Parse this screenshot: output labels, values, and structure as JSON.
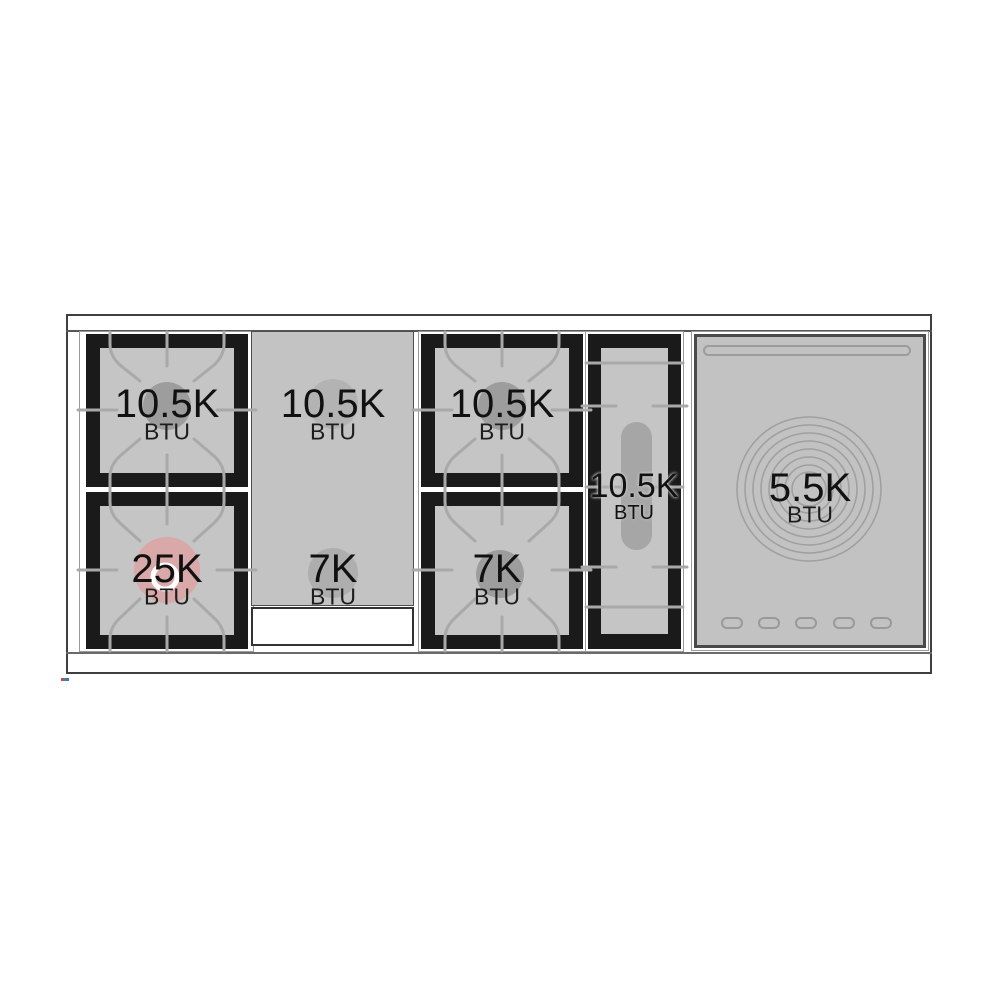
{
  "diagram": {
    "name": "range-cooktop-btu-diagram",
    "burners": [
      {
        "id": "left-top",
        "value": "10.5K",
        "unit": "BTU"
      },
      {
        "id": "left-bottom",
        "value": "25K",
        "unit": "BTU",
        "highlight": true
      },
      {
        "id": "griddle-top",
        "value": "10.5K",
        "unit": "BTU"
      },
      {
        "id": "griddle-bottom",
        "value": "7K",
        "unit": "BTU"
      },
      {
        "id": "middle-top",
        "value": "10.5K",
        "unit": "BTU"
      },
      {
        "id": "middle-bottom",
        "value": "7K",
        "unit": "BTU"
      },
      {
        "id": "oval",
        "value": "10.5K",
        "unit": "BTU"
      },
      {
        "id": "french-plate",
        "value": "5.5K",
        "unit": "BTU"
      }
    ],
    "colors": {
      "grate_black": "#1a1a1a",
      "well_gray": "#c5c5c5",
      "burner_gray": "#9d9d9d",
      "highlight_pink": "#d9a8a8",
      "line_gray": "#a9a9a9"
    }
  }
}
